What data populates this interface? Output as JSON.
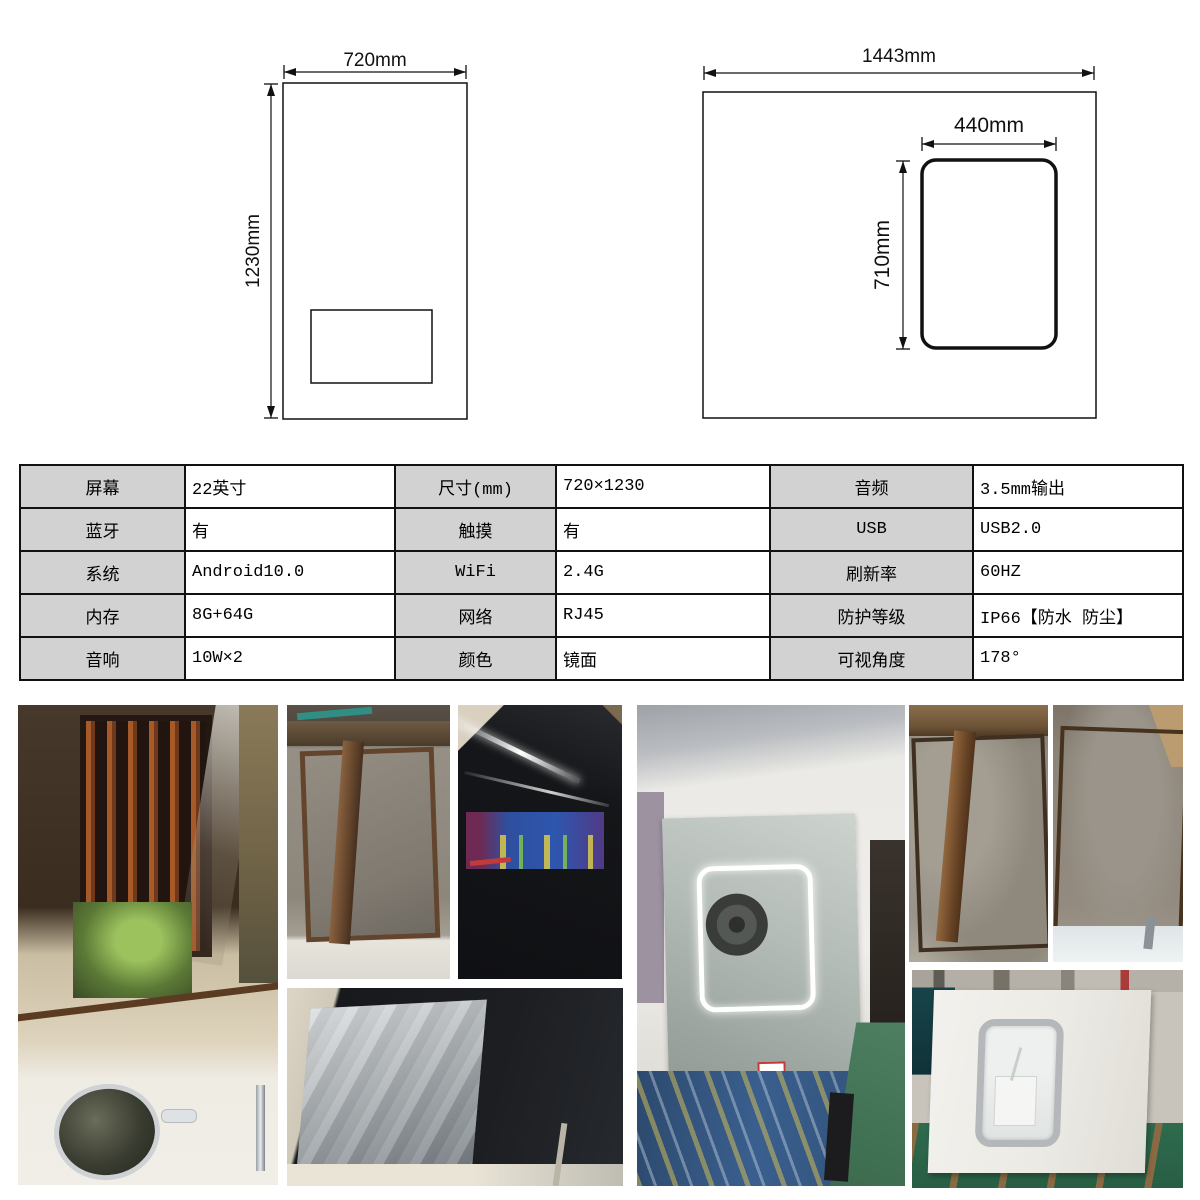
{
  "diagrams": {
    "front_view": {
      "width_label": "720mm",
      "height_label": "1230mm"
    },
    "rear_view": {
      "width_label": "1443mm",
      "screen_width_label": "440mm",
      "screen_height_label": "710mm"
    }
  },
  "spec_table": {
    "label_bg": "#d2d2d2",
    "border_color": "#111111",
    "rows": [
      [
        {
          "label": "屏幕",
          "value": "22英寸"
        },
        {
          "label": "尺寸(mm)",
          "value": "720×1230"
        },
        {
          "label": "音频",
          "value": "3.5mm输出"
        }
      ],
      [
        {
          "label": "蓝牙",
          "value": "有"
        },
        {
          "label": "触摸",
          "value": "有"
        },
        {
          "label": "USB",
          "value": "USB2.0"
        }
      ],
      [
        {
          "label": "系统",
          "value": "Android10.0"
        },
        {
          "label": "WiFi",
          "value": "2.4G"
        },
        {
          "label": "刷新率",
          "value": "60HZ"
        }
      ],
      [
        {
          "label": "内存",
          "value": "8G+64G"
        },
        {
          "label": "网络",
          "value": "RJ45"
        },
        {
          "label": "防护等级",
          "value": "IP66【防水 防尘】"
        }
      ],
      [
        {
          "label": "音响",
          "value": "10W×2"
        },
        {
          "label": "颜色",
          "value": "镜面"
        },
        {
          "label": "可视角度",
          "value": "178°"
        }
      ]
    ]
  },
  "photos": [
    {
      "name": "photo-bathroom-mirror-installed"
    },
    {
      "name": "photo-wall-frame-installation"
    },
    {
      "name": "photo-dark-mirror-screen-on"
    },
    {
      "name": "photo-panel-with-protective-film"
    },
    {
      "name": "photo-factory-led-mirror"
    },
    {
      "name": "photo-mirror-back-frame-left"
    },
    {
      "name": "photo-mirror-back-frame-right"
    },
    {
      "name": "photo-white-back-panel-cutout"
    }
  ]
}
